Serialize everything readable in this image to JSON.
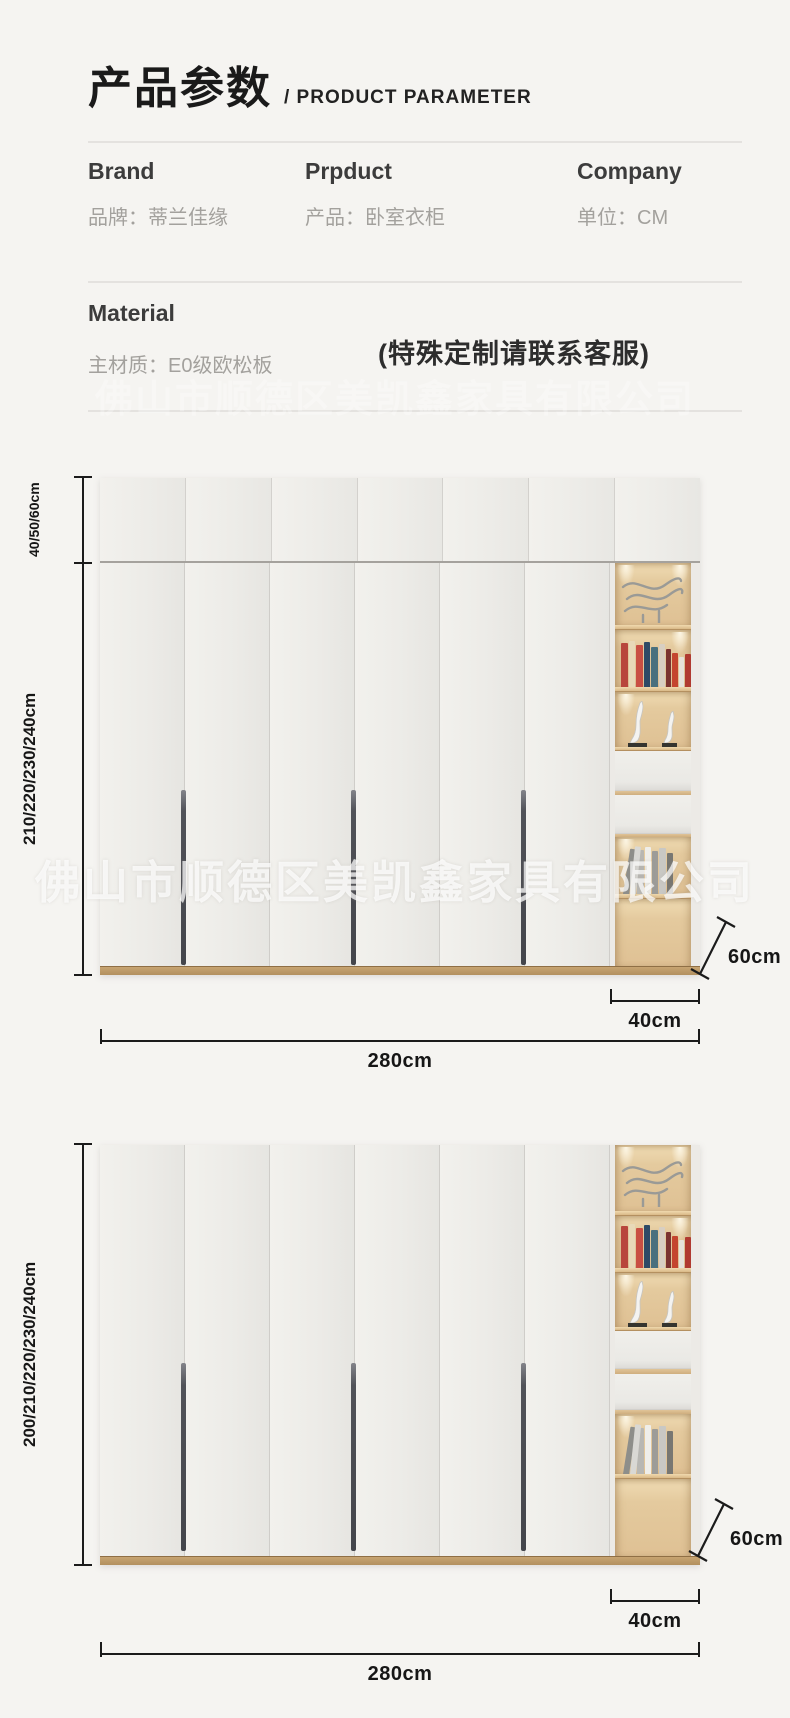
{
  "header": {
    "title_cn": "产品参数",
    "title_en": "/ PRODUCT PARAMETER",
    "fields": [
      {
        "label_en": "Brand",
        "label_cn": "品牌：蒂兰佳缘"
      },
      {
        "label_en": "Prpduct",
        "label_cn": "产品：卧室衣柜"
      },
      {
        "label_en": "Company",
        "label_cn": "单位：CM"
      }
    ],
    "material": {
      "label_en": "Material",
      "label_cn": "主材质：E0级欧松板"
    },
    "custom_note": "(特殊定制请联系客服)"
  },
  "watermark": {
    "company": "佛山市顺德区美凯鑫家具有限公司"
  },
  "diagram_first": {
    "top_height": "40/50/60cm",
    "body_height": "210/220/230/240cm",
    "width": "280cm",
    "side_cabinet_width": "40cm",
    "depth": "60cm"
  },
  "diagram_second": {
    "body_height": "200/210/220/230/240cm",
    "width": "280cm",
    "side_cabinet_width": "40cm",
    "depth": "60cm"
  },
  "colors": {
    "page_background": "#f5f4f1",
    "door_face": "#edece8",
    "wood_interior": "#e3c79c",
    "wood_shelf": "#d9b988",
    "plinth": "#b2905e",
    "handle": "#4c4d53",
    "dimension_ink": "#1b1b1b",
    "label_gray": "#a3a19d",
    "text_dark": "#2d2d2d",
    "watermark_white": "#ffffff"
  }
}
